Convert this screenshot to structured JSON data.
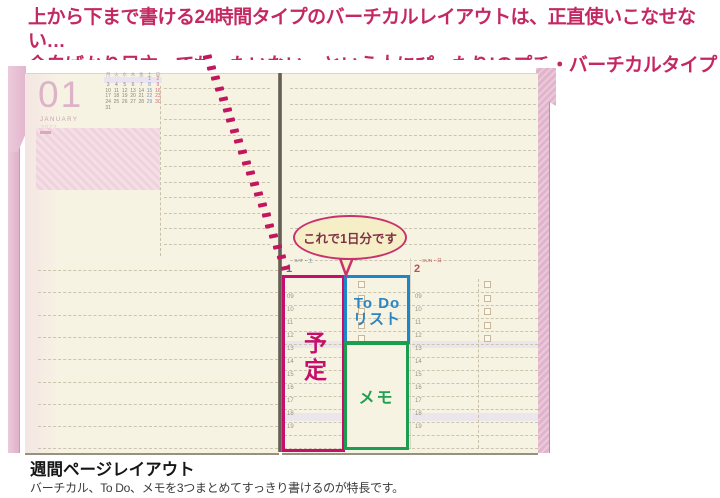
{
  "page_header": {
    "line1": "上から下まで書ける24時間タイプのバーチカルレイアウトは、正直使いこなせない…",
    "line2": "余白ばかり目立ってもったいない…という人にぴったり!のプチ・バーチカルタイプです。"
  },
  "planner": {
    "month": {
      "number": "01",
      "name": "JANUARY",
      "year": "2022"
    },
    "mini_calendar": {
      "weekdays": [
        "月",
        "火",
        "水",
        "木",
        "金",
        "土",
        "日"
      ],
      "rows": [
        [
          "",
          "",
          "",
          "",
          "",
          "1",
          "2"
        ],
        [
          "3",
          "4",
          "5",
          "6",
          "7",
          "8",
          "9"
        ],
        [
          "10",
          "11",
          "12",
          "13",
          "14",
          "15",
          "16"
        ],
        [
          "17",
          "18",
          "19",
          "20",
          "21",
          "22",
          "23"
        ],
        [
          "24",
          "25",
          "26",
          "27",
          "28",
          "29",
          "30"
        ],
        [
          "31",
          "",
          "",
          "",
          "",
          "",
          ""
        ]
      ]
    },
    "days": [
      {
        "number": "1",
        "label": "SAT・土"
      },
      {
        "number": "2",
        "label": "SUN・日"
      }
    ],
    "hours": [
      "09",
      "10",
      "11",
      "12",
      "13",
      "14",
      "15",
      "16",
      "17",
      "18",
      "19"
    ]
  },
  "callout": {
    "text": "これで1日分です"
  },
  "annotations": {
    "schedule": "予定",
    "todo_line1": "To Do",
    "todo_line2": "リスト",
    "memo": "メモ"
  },
  "caption": {
    "title": "週間ページレイアウト",
    "subtitle": "バーチカル、To Do、メモを3つまとめてすっきり書けるのが特長です。"
  },
  "colors": {
    "accent_pink": "#c32862",
    "magenta_box": "#c50f6b",
    "blue_box": "#1b86c8",
    "green_box": "#1a9e50",
    "bubble_fill": "#f6eec6",
    "bubble_border": "#c6336f",
    "page_cream": "#f7f3e3",
    "cover_pink": "#e5bad0"
  }
}
